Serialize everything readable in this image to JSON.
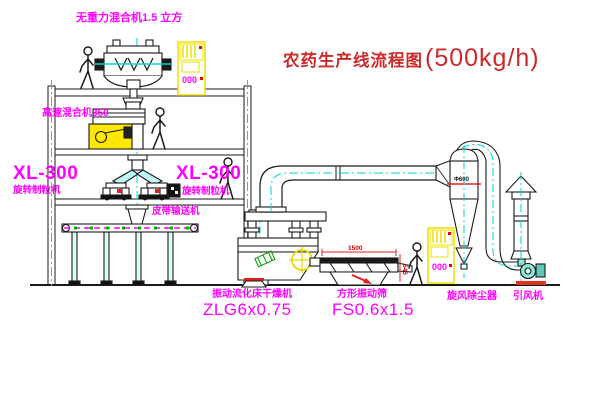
{
  "title": {
    "name": "农药生产线流程图",
    "capacity": "(500kg/h)"
  },
  "labels": {
    "gravity_mixer": "无重力混合机1.5 立方",
    "high_speed_mixer": "高速混合机350",
    "granulator_model_left": "XL-300",
    "granulator_name_left": "旋转制粒机",
    "granulator_model_mid": "XL-300",
    "granulator_name_mid": "旋转制粒机",
    "belt_conveyor": "皮带输送机",
    "dryer_name": "振动流化床干燥机",
    "dryer_model": "ZLG6x0.75",
    "sieve_name": "方形振动筛",
    "sieve_model": "FS0.6x1.5",
    "cyclone": "旋风除尘器",
    "fan": "引风机"
  },
  "dimensions": {
    "cyclone_diameter": "Φ600",
    "sieve_length": "1500",
    "sieve_height": "545"
  },
  "cabinets": {
    "display": "000"
  },
  "colors": {
    "line": "#1a1a1a",
    "magenta": "#ff00ff",
    "red": "#dd2222",
    "yellow": "#efe000",
    "cyan": "#00d5d5",
    "green": "#00aa00",
    "title_red": "#cc2a2a"
  }
}
